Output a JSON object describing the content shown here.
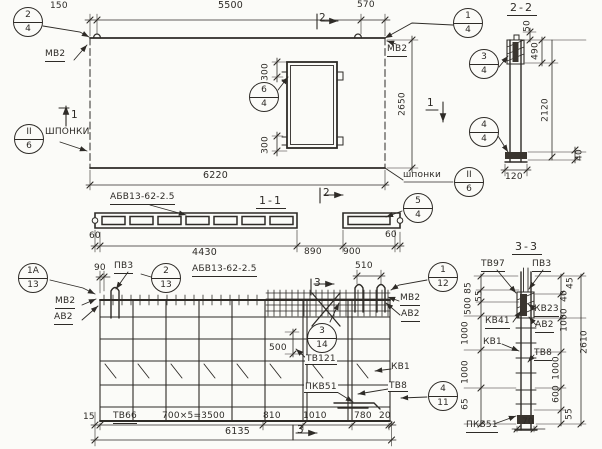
{
  "plan": {
    "balloon_2_4": {
      "top": "2",
      "bot": "4"
    },
    "balloon_1_4": {
      "top": "1",
      "bot": "4"
    },
    "balloon_6_4": {
      "top": "6",
      "bot": "4"
    },
    "balloon_keys": {
      "top": "II",
      "bot": "6"
    },
    "label_mv2": "МВ2",
    "label_shponki_caps": "ШПОНКИ",
    "label_shponki": "шпонки",
    "cut_1": "1",
    "cut_2": "2",
    "dim_150": "150",
    "dim_5500": "5500",
    "dim_570": "570",
    "dim_2650": "2650",
    "dim_6220": "6220",
    "dim_300": "300"
  },
  "section22": {
    "title": "2-2",
    "balloon_3_4": {
      "top": "3",
      "bot": "4"
    },
    "balloon_4_4": {
      "top": "4",
      "bot": "4"
    },
    "dim_50": "50",
    "dim_490": "490",
    "dim_2120": "2120",
    "dim_40": "40",
    "dim_120": "120"
  },
  "section11": {
    "title": "1-1",
    "mesh_mark": "АБВ13-62-2.5",
    "balloon_5_4": {
      "top": "5",
      "bot": "4"
    },
    "dim_60_left": "60",
    "dim_4430": "4430",
    "dim_890": "890",
    "dim_900": "900",
    "dim_60_right": "60"
  },
  "rebar_plan": {
    "title": "АБВ13-62-2.5",
    "balloon_1a_13": {
      "top": "1А",
      "bot": "13"
    },
    "balloon_2_13": {
      "top": "2",
      "bot": "13"
    },
    "balloon_3_14": {
      "top": "3",
      "bot": "14"
    },
    "balloon_1_12": {
      "top": "1",
      "bot": "12"
    },
    "balloon_4_11": {
      "top": "4",
      "bot": "11"
    },
    "cut_3": "3",
    "label_pv3": "ПВ3",
    "label_mv2": "МВ2",
    "label_av2": "АВ2",
    "label_tv121": "ТВ121",
    "label_kv1": "КВ1",
    "label_tv8": "ТВ8",
    "label_pkv51": "ПКВ51",
    "label_tv66": "ТВ66",
    "dim_90": "90",
    "dim_510": "510",
    "dim_500": "500",
    "dim_15": "15",
    "dim_spacing": "700×5=3500",
    "dim_810": "810",
    "dim_1010": "1010",
    "dim_780": "780",
    "dim_20": "20",
    "dim_6135": "6135"
  },
  "section33": {
    "title": "3-3",
    "label_tv97": "ТВ97",
    "label_pv3": "ПВ3",
    "label_kv23": "КВ23",
    "label_kv41": "КВ41",
    "label_av2": "АВ2",
    "label_kv1": "КВ1",
    "label_tv8": "ТВ8",
    "label_pkv51": "ПКВ51",
    "dim_55_top": "55",
    "dim_85": "85",
    "dim_500": "500",
    "dim_1000_a": "1000",
    "dim_1000_b": "1000",
    "dim_65": "65",
    "dim_45": "45",
    "dim_40": "40",
    "dim_1000_c": "1000",
    "dim_1000_d": "1000",
    "dim_600": "600",
    "dim_55_bot": "55",
    "dim_2610": "2610",
    "dim_70": "70"
  }
}
